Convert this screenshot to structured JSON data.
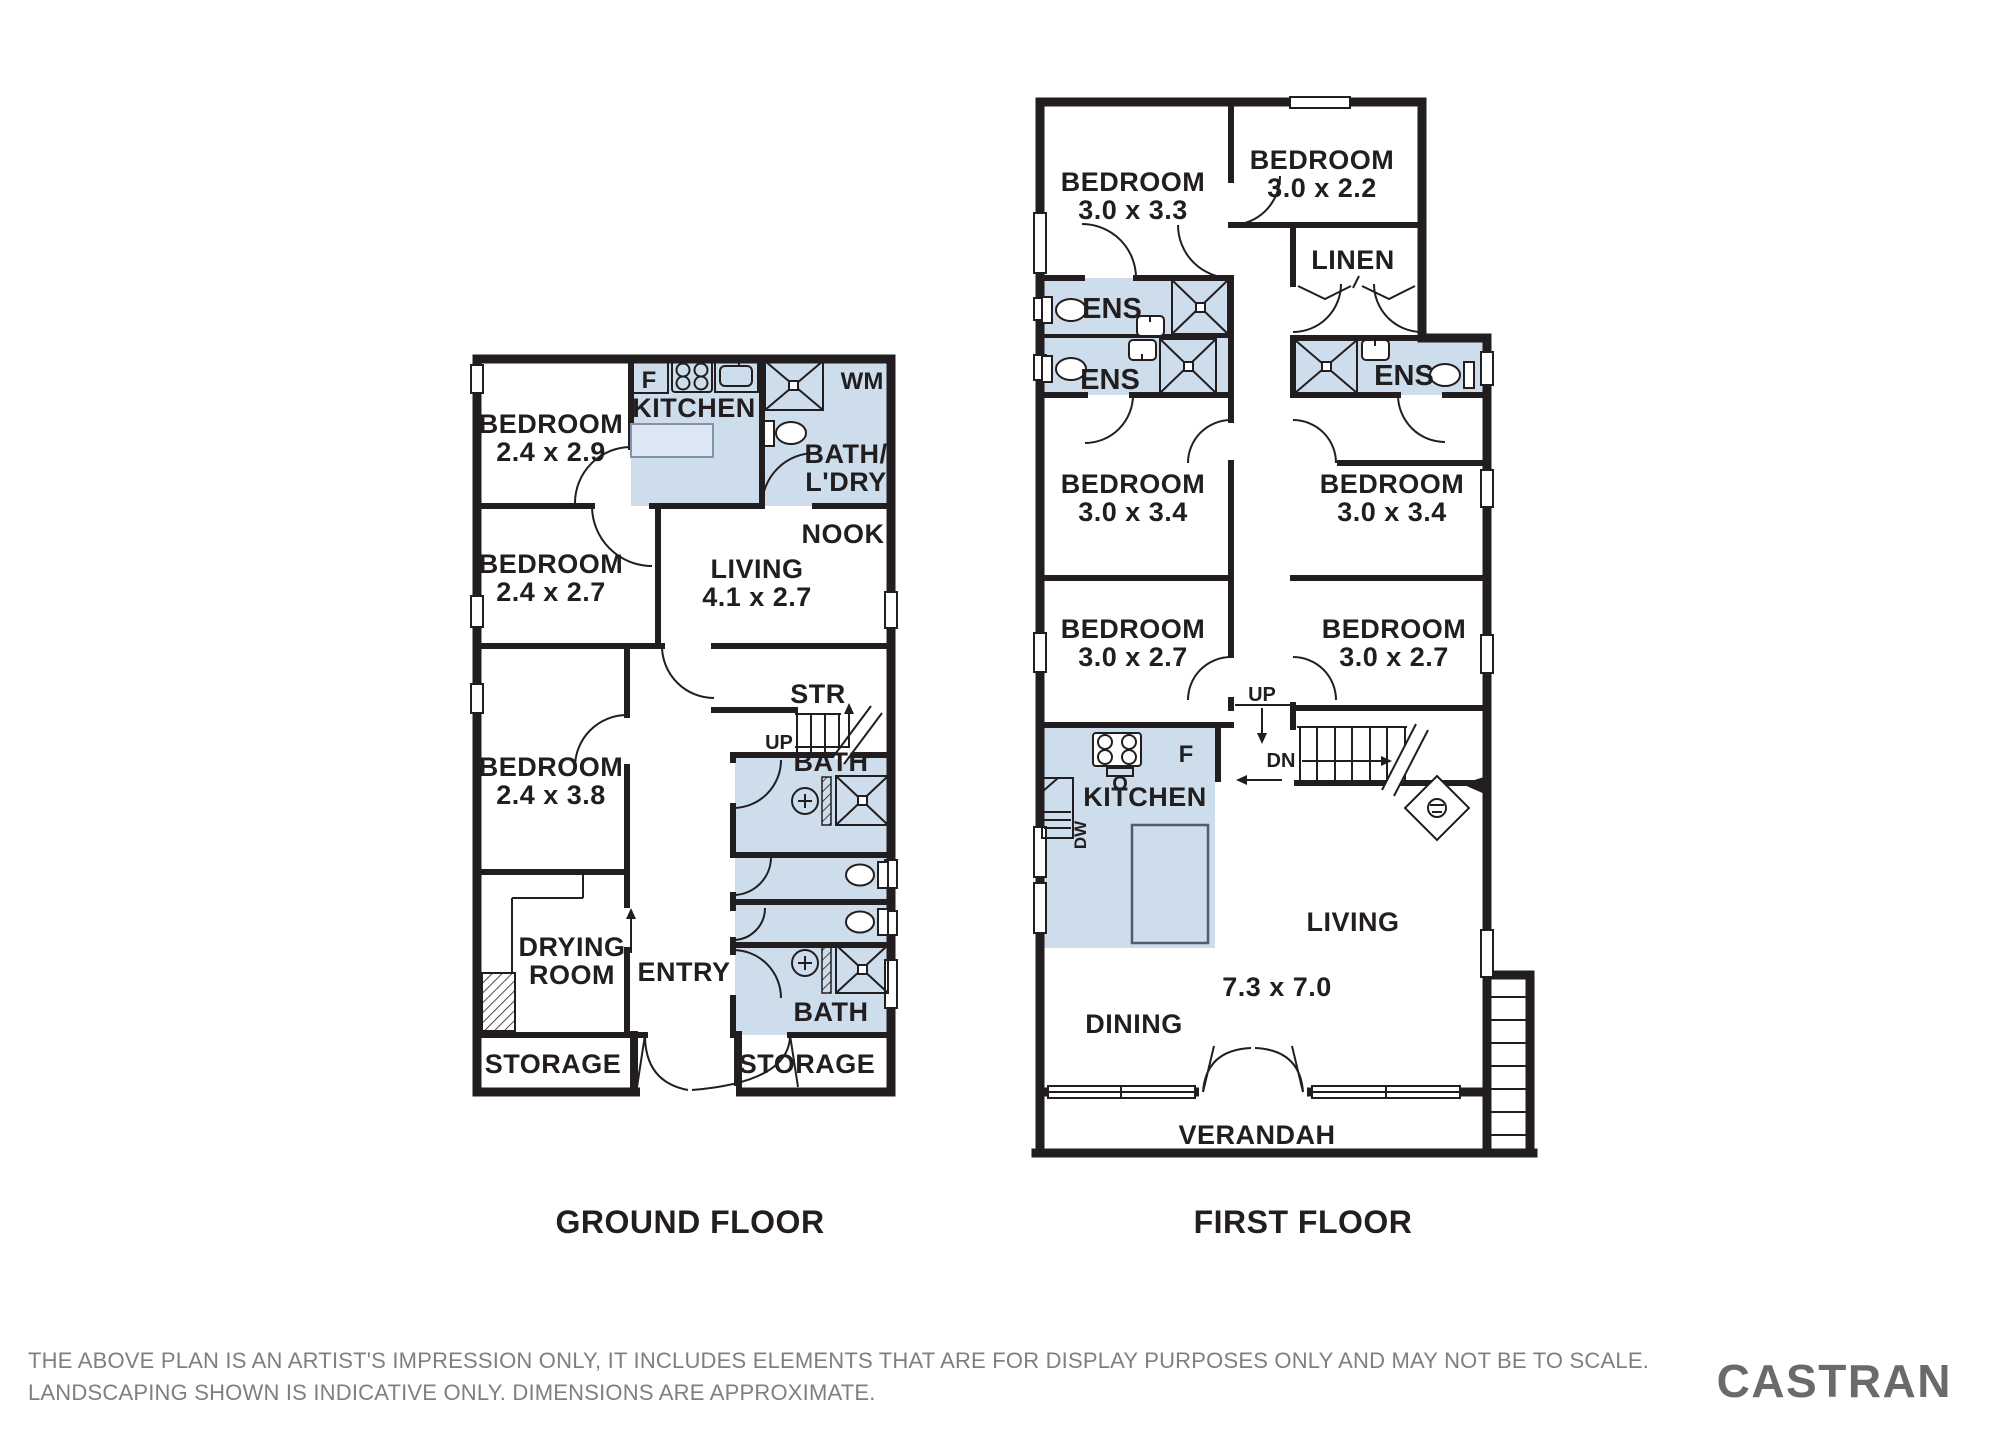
{
  "ground": {
    "title": "GROUND FLOOR",
    "rooms": {
      "bed1": {
        "name": "BEDROOM",
        "dims": "2.4 x 2.9"
      },
      "bed2": {
        "name": "BEDROOM",
        "dims": "2.4 x 2.7"
      },
      "bed3": {
        "name": "BEDROOM",
        "dims": "2.4 x 3.8"
      },
      "kitchen": {
        "name": "KITCHEN"
      },
      "bath_ldry": {
        "line1": "BATH/",
        "line2": "L'DRY"
      },
      "nook": {
        "name": "NOOK"
      },
      "living": {
        "name": "LIVING",
        "dims": "4.1 x 2.7"
      },
      "stairs": {
        "name": "STR",
        "up": "UP"
      },
      "bath_upper": {
        "name": "BATH"
      },
      "bath_lower": {
        "name": "BATH"
      },
      "drying": {
        "line1": "DRYING",
        "line2": "ROOM"
      },
      "entry": {
        "name": "ENTRY"
      },
      "storage_left": {
        "name": "STORAGE"
      },
      "storage_right": {
        "name": "STORAGE"
      }
    },
    "appliances": {
      "fridge": "F",
      "washing_machine": "WM"
    }
  },
  "first": {
    "title": "FIRST FLOOR",
    "rooms": {
      "bedA": {
        "name": "BEDROOM",
        "dims": "3.0 x 3.3"
      },
      "bedB": {
        "name": "BEDROOM",
        "dims": "3.0 x 2.2"
      },
      "linen": {
        "name": "LINEN"
      },
      "ens1": {
        "name": "ENS"
      },
      "ens2": {
        "name": "ENS"
      },
      "ens3": {
        "name": "ENS"
      },
      "bedC": {
        "name": "BEDROOM",
        "dims": "3.0 x 3.4"
      },
      "bedD": {
        "name": "BEDROOM",
        "dims": "3.0 x 3.4"
      },
      "bedE": {
        "name": "BEDROOM",
        "dims": "3.0 x 2.7"
      },
      "bedF": {
        "name": "BEDROOM",
        "dims": "3.0 x 2.7"
      },
      "kitchen": {
        "name": "KITCHEN"
      },
      "living": {
        "name": "LIVING",
        "dims": "7.3 x 7.0"
      },
      "dining": {
        "name": "DINING"
      },
      "verandah": {
        "name": "VERANDAH"
      },
      "stairs": {
        "up": "UP",
        "dn": "DN"
      }
    },
    "appliances": {
      "fridge": "F",
      "oven": "O",
      "dishwasher": "DW"
    }
  },
  "footer": {
    "disclaimer_line1": "THE ABOVE PLAN IS AN ARTIST'S IMPRESSION ONLY, IT INCLUDES ELEMENTS THAT ARE FOR DISPLAY PURPOSES ONLY AND MAY NOT BE TO SCALE.",
    "disclaimer_line2": "LANDSCAPING SHOWN IS INDICATIVE ONLY. DIMENSIONS ARE APPROXIMATE.",
    "brand": "CASTRAN"
  },
  "colors": {
    "wall": "#221e1f",
    "wet_area": "#cdddec",
    "counter_fill": "#dde7f3",
    "disclaimer_gray": "#7f7f7f",
    "brand_gray": "#6a6a6a"
  }
}
